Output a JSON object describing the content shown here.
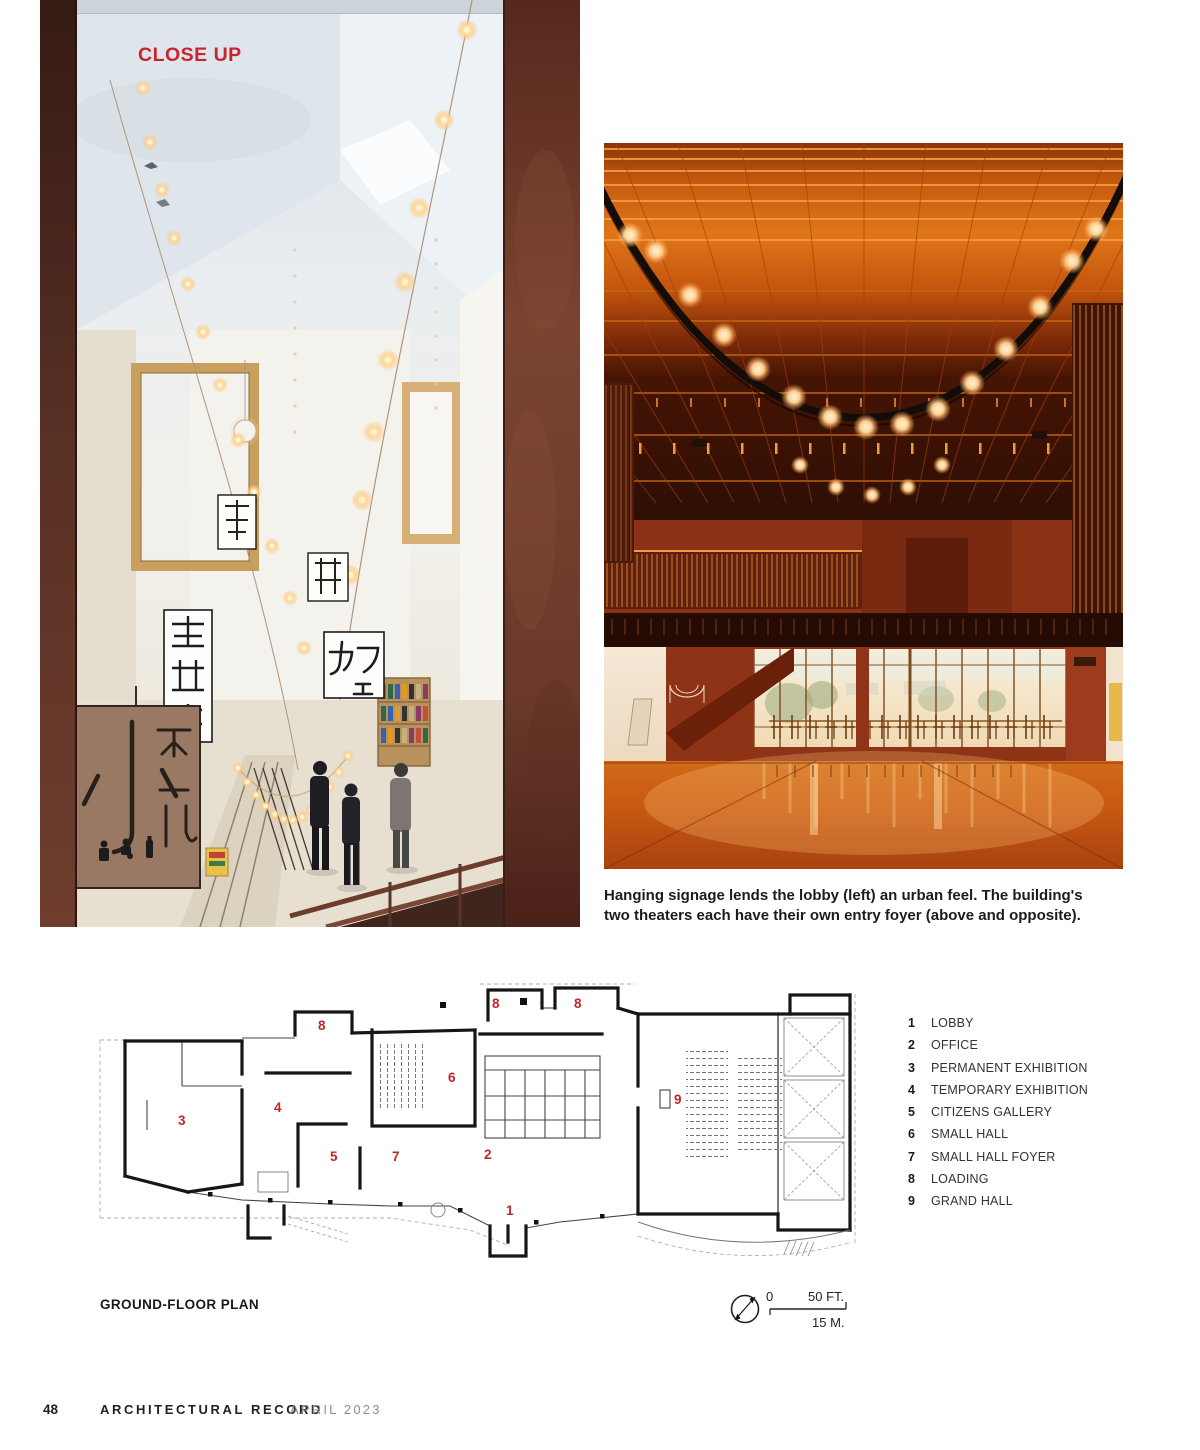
{
  "close_up_label": "CLOSE UP",
  "accent_red": "#c8232e",
  "plan_red": "#c0272d",
  "left_photo": {
    "signs": {
      "small_hall_sign": "小ホール",
      "cafe_sign": "カフェ",
      "hanging_signs_note": "轄動新"
    }
  },
  "caption": {
    "line1": "Hanging signage lends the lobby (left) an urban feel. The building's",
    "line2": "two theaters each have their own entry foyer (above and opposite)."
  },
  "plan": {
    "title": "GROUND-FLOOR PLAN",
    "legend": [
      {
        "n": "1",
        "label": "LOBBY"
      },
      {
        "n": "2",
        "label": "OFFICE"
      },
      {
        "n": "3",
        "label": "PERMANENT EXHIBITION"
      },
      {
        "n": "4",
        "label": "TEMPORARY EXHIBITION"
      },
      {
        "n": "5",
        "label": "CITIZENS GALLERY"
      },
      {
        "n": "6",
        "label": "SMALL HALL"
      },
      {
        "n": "7",
        "label": "SMALL HALL FOYER"
      },
      {
        "n": "8",
        "label": "LOADING"
      },
      {
        "n": "9",
        "label": "GRAND HALL"
      }
    ],
    "labels": [
      {
        "t": "3",
        "x": 88,
        "y": 147
      },
      {
        "t": "4",
        "x": 184,
        "y": 134
      },
      {
        "t": "5",
        "x": 240,
        "y": 183
      },
      {
        "t": "7",
        "x": 302,
        "y": 183
      },
      {
        "t": "6",
        "x": 358,
        "y": 104
      },
      {
        "t": "2",
        "x": 394,
        "y": 181
      },
      {
        "t": "1",
        "x": 416,
        "y": 237
      },
      {
        "t": "9",
        "x": 584,
        "y": 126
      },
      {
        "t": "8",
        "x": 228,
        "y": 52
      },
      {
        "t": "8",
        "x": 402,
        "y": 30
      },
      {
        "t": "8",
        "x": 484,
        "y": 30
      }
    ],
    "scale": {
      "zero": "0",
      "feet": "50 FT.",
      "meters": "15 M."
    }
  },
  "footer": {
    "page_number": "48",
    "magazine": "ARCHITECTURAL RECORD",
    "issue": "APRIL 2023"
  }
}
